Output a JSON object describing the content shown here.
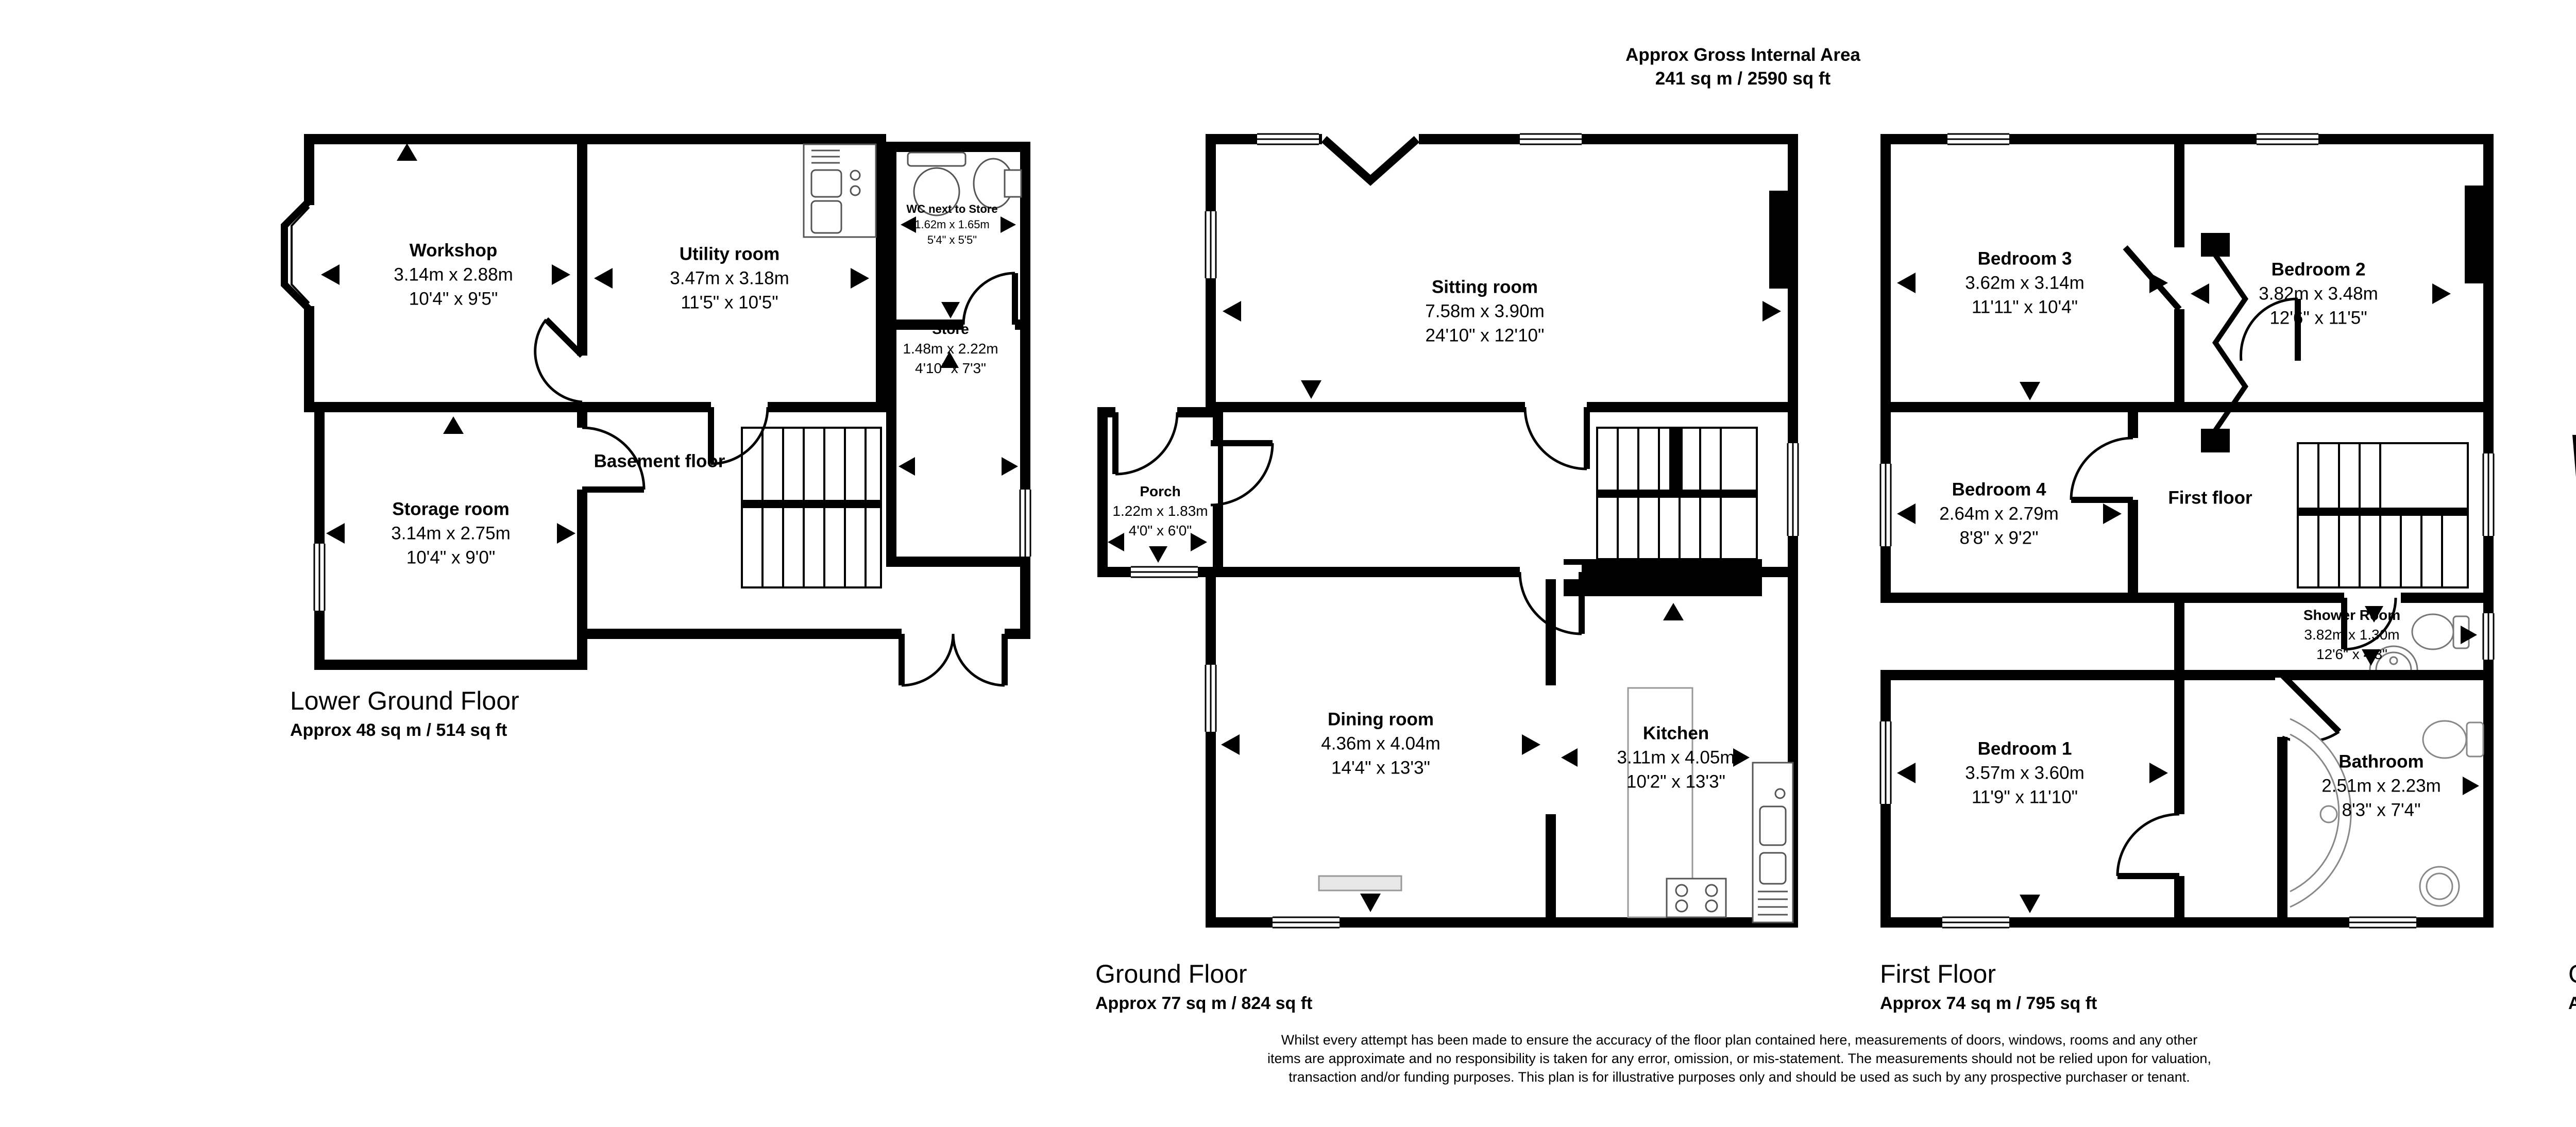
{
  "header": {
    "line1": "Approx Gross Internal Area",
    "line2": "241 sq m / 2590 sq ft"
  },
  "compass": {
    "n": "N",
    "e": "E",
    "s": "S",
    "w": "W"
  },
  "floors": [
    {
      "name": "Lower Ground Floor",
      "area_label": "Approx 48 sq m / 514 sq ft",
      "rooms": [
        {
          "name": "Workshop",
          "metric": "3.14m x 2.88m",
          "imperial": "10'4\" x 9'5\""
        },
        {
          "name": "Utility room",
          "metric": "3.47m x 3.18m",
          "imperial": "11'5\" x 10'5\""
        },
        {
          "name": "WC next to Store",
          "metric": "1.62m x 1.65m",
          "imperial": "5'4\" x 5'5\""
        },
        {
          "name": "Store",
          "metric": "1.48m x 2.22m",
          "imperial": "4'10\" x 7'3\""
        },
        {
          "name": "Basement floor"
        },
        {
          "name": "Storage room",
          "metric": "3.14m x 2.75m",
          "imperial": "10'4\" x 9'0\""
        }
      ]
    },
    {
      "name": "Ground Floor",
      "area_label": "Approx 77 sq m / 824 sq ft",
      "rooms": [
        {
          "name": "Sitting room",
          "metric": "7.58m x 3.90m",
          "imperial": "24'10\" x 12'10\""
        },
        {
          "name": "Porch",
          "metric": "1.22m x 1.83m",
          "imperial": "4'0\" x 6'0\""
        },
        {
          "name": "Dining room",
          "metric": "4.36m x 4.04m",
          "imperial": "14'4\" x 13'3\""
        },
        {
          "name": "Kitchen",
          "metric": "3.11m x 4.05m",
          "imperial": "10'2\" x 13'3\""
        }
      ]
    },
    {
      "name": "First Floor",
      "area_label": "Approx 74 sq m / 795 sq ft",
      "rooms": [
        {
          "name": "Bedroom 3",
          "metric": "3.62m x 3.14m",
          "imperial": "11'11\" x 10'4\""
        },
        {
          "name": "Bedroom 2",
          "metric": "3.82m x 3.48m",
          "imperial": "12'6\" x 11'5\""
        },
        {
          "name": "Bedroom 4",
          "metric": "2.64m x 2.79m",
          "imperial": "8'8\" x 9'2\""
        },
        {
          "name": "First floor"
        },
        {
          "name": "Shower Room",
          "metric": "3.82m x 1.30m",
          "imperial": "12'6\" x 4'3\""
        },
        {
          "name": "Bedroom 1",
          "metric": "3.57m x 3.60m",
          "imperial": "11'9\" x 11'10\""
        },
        {
          "name": "Bathroom",
          "metric": "2.51m x 2.23m",
          "imperial": "8'3\" x 7'4\""
        }
      ]
    },
    {
      "name": "Garage",
      "area_label": "Approx 42 sq m / 457 sq ft",
      "rooms": [
        {
          "name": "Double garage under basement",
          "metric": "7.75m x 5.87m",
          "imperial": "25'5\" x 19'3\""
        }
      ]
    }
  ],
  "disclaimer": "Whilst every attempt has been made to ensure the accuracy of the floor plan contained here, measurements of doors, windows, rooms and any other items are approximate and no responsibility is taken for any error, omission, or mis-statement. The measurements should not be relied upon for valuation, transaction and/or funding purposes. This plan is for illustrative purposes only and should be used as such by any prospective purchaser or tenant."
}
